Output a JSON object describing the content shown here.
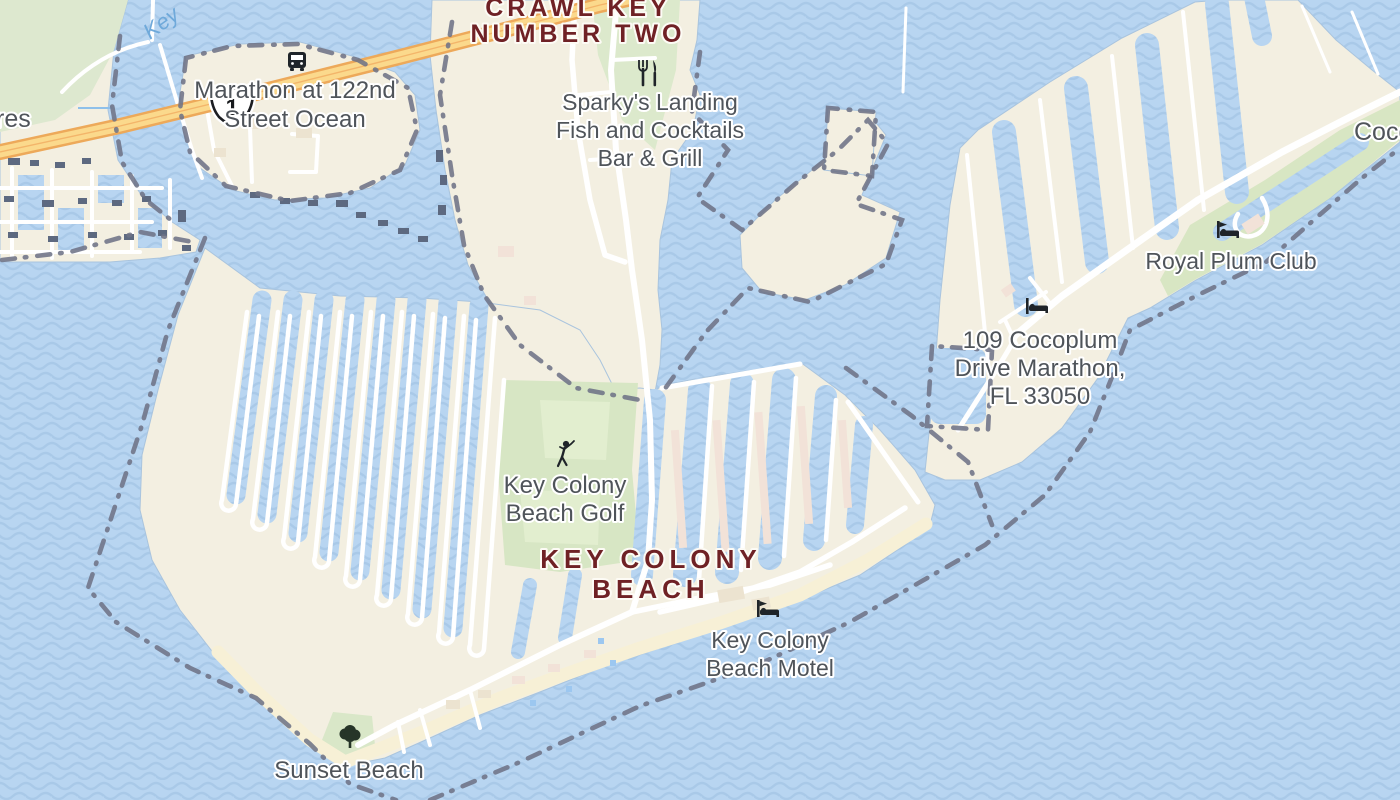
{
  "map": {
    "labels": {
      "crawl_key": {
        "lines": [
          "CRAWL KEY",
          "NUMBER TWO"
        ]
      },
      "marathon122": {
        "lines": [
          "Marathon at 122nd",
          "Street Ocean"
        ]
      },
      "sparkys": {
        "lines": [
          "Sparky's Landing",
          "Fish and Cocktails",
          "Bar & Grill"
        ]
      },
      "royal_plum": {
        "text": "Royal Plum Club"
      },
      "cocoplum_addr": {
        "lines": [
          "109 Cocoplum",
          "Drive Marathon,",
          "FL 33050"
        ]
      },
      "golf": {
        "lines": [
          "Key Colony",
          "Beach Golf"
        ]
      },
      "kcb": {
        "lines": [
          "KEY COLONY",
          "BEACH"
        ]
      },
      "motel": {
        "lines": [
          "Key Colony",
          "Beach Motel"
        ]
      },
      "sunset": {
        "text": "Sunset Beach"
      },
      "partial_left": {
        "text": "res"
      },
      "partial_right": {
        "text": "Coco"
      },
      "water_label": {
        "text": "Key"
      }
    },
    "route_shield": {
      "number": "1"
    },
    "icons": [
      "bus-icon",
      "restaurant-icon",
      "lodging-icon",
      "golf-icon",
      "tree-icon",
      "us-route-shield-icon"
    ],
    "colors": {
      "water_base": "#b8d5f1",
      "water_wave": "#a9c9e8",
      "land": "#f3efe1",
      "green": "#dde8cf",
      "golf_green": "#d7e6c4",
      "sand": "#f7f0d6",
      "highway_fill": "#fbd98c",
      "highway_casing": "#eda95a",
      "boundary": "#6e7386",
      "poi_text": "#4f545a",
      "city_text": "#6f2125",
      "water_text": "#6fa9da",
      "dock": "#5d6980",
      "building": "#f2e2d8"
    }
  }
}
